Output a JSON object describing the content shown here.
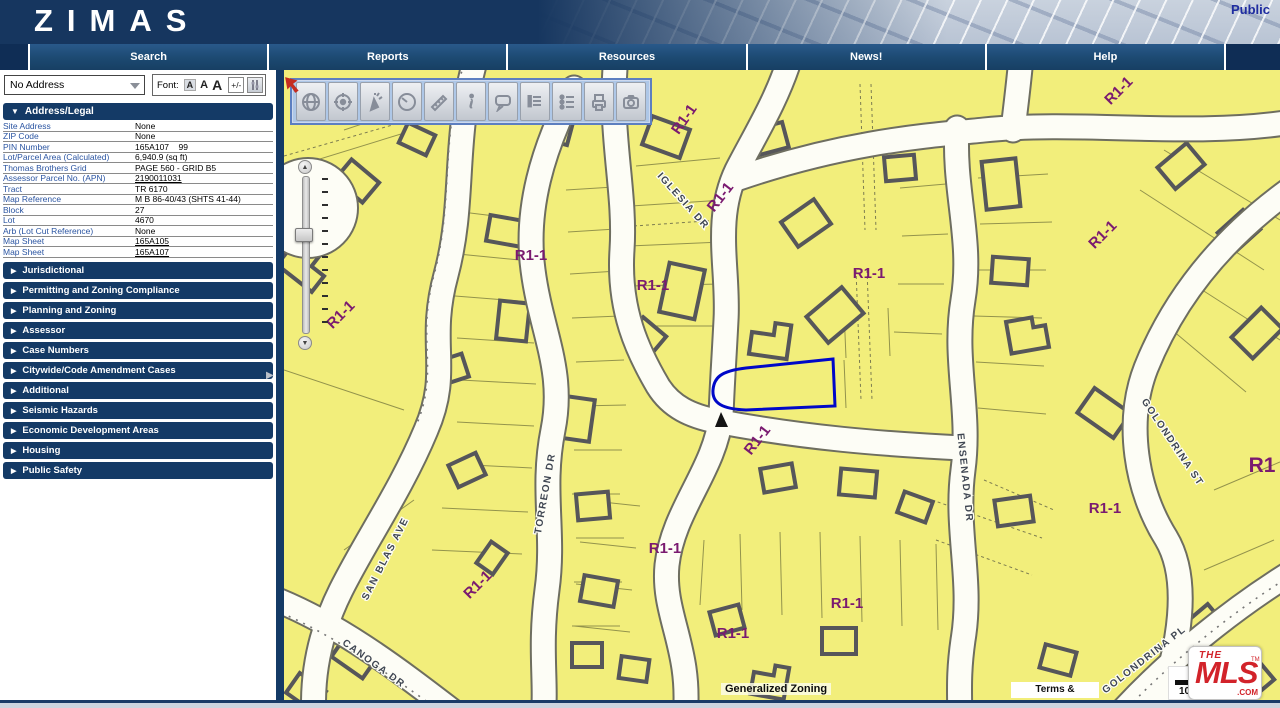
{
  "header": {
    "logo": "ZIMAS",
    "public_label": "Public"
  },
  "tabs": [
    {
      "label": "Search"
    },
    {
      "label": "Reports"
    },
    {
      "label": "Resources"
    },
    {
      "label": "News!"
    },
    {
      "label": "Help"
    }
  ],
  "sidebar": {
    "address_dropdown_value": "No Address",
    "font_label": "Font:",
    "font_sizes": [
      "A",
      "A",
      "A"
    ],
    "font_plusminus": "+/-",
    "address_legal": {
      "title": "Address/Legal",
      "rows": [
        {
          "label": "Site Address",
          "value": "None",
          "link": false
        },
        {
          "label": "ZIP Code",
          "value": "None",
          "link": false
        },
        {
          "label": "PIN Number",
          "value": "165A107    99",
          "link": false
        },
        {
          "label": "Lot/Parcel Area (Calculated)",
          "value": "6,940.9 (sq ft)",
          "link": false
        },
        {
          "label": "Thomas Brothers Grid",
          "value": "PAGE 560 - GRID B5",
          "link": false
        },
        {
          "label": "Assessor Parcel No. (APN)",
          "value": "2190011031",
          "link": true
        },
        {
          "label": "Tract",
          "value": "TR 6170",
          "link": false
        },
        {
          "label": "Map Reference",
          "value": "M B 86-40/43 (SHTS 41-44)",
          "link": false
        },
        {
          "label": "Block",
          "value": "27",
          "link": false
        },
        {
          "label": "Lot",
          "value": "4670",
          "link": false
        },
        {
          "label": "Arb (Lot Cut Reference)",
          "value": "None",
          "link": false
        },
        {
          "label": "Map Sheet",
          "value": "165A105",
          "link": true
        },
        {
          "label": "Map Sheet",
          "value": "165A107",
          "link": true
        }
      ]
    },
    "sections": [
      "Jurisdictional",
      "Permitting and Zoning Compliance",
      "Planning and Zoning",
      "Assessor",
      "Case Numbers",
      "Citywide/Code Amendment Cases",
      "Additional",
      "Seismic Hazards",
      "Economic Development Areas",
      "Housing",
      "Public Safety"
    ]
  },
  "map": {
    "toolbar_buttons": [
      "globe",
      "locate",
      "select-arrow",
      "clock",
      "measure",
      "info",
      "comment",
      "report",
      "legend",
      "print",
      "photo"
    ],
    "zone_labels": [
      {
        "text": "R1-1",
        "x": 404,
        "y": 52,
        "rot": -55,
        "big": false
      },
      {
        "text": "R1-1",
        "x": 440,
        "y": 130,
        "rot": -52,
        "big": false
      },
      {
        "text": "R1-1",
        "x": 247,
        "y": 190,
        "rot": 0,
        "big": false
      },
      {
        "text": "R1-1",
        "x": 369,
        "y": 220,
        "rot": 0,
        "big": false
      },
      {
        "text": "R1-1",
        "x": 60,
        "y": 248,
        "rot": -45,
        "big": false
      },
      {
        "text": "R1-1",
        "x": 585,
        "y": 208,
        "rot": 0,
        "big": false
      },
      {
        "text": "R1-1",
        "x": 822,
        "y": 168,
        "rot": -45,
        "big": false
      },
      {
        "text": "R1-1",
        "x": 838,
        "y": 24,
        "rot": -45,
        "big": false
      },
      {
        "text": "R1-1",
        "x": 477,
        "y": 373,
        "rot": -52,
        "big": false
      },
      {
        "text": "R1-1",
        "x": 381,
        "y": 483,
        "rot": 0,
        "big": false
      },
      {
        "text": "R1-1",
        "x": 197,
        "y": 518,
        "rot": -45,
        "big": false
      },
      {
        "text": "R1-1",
        "x": 449,
        "y": 568,
        "rot": 0,
        "big": false
      },
      {
        "text": "R1-1",
        "x": 563,
        "y": 538,
        "rot": 0,
        "big": false
      },
      {
        "text": "R1-1",
        "x": 821,
        "y": 443,
        "rot": 0,
        "big": false
      },
      {
        "text": "R1",
        "x": 978,
        "y": 402,
        "rot": 0,
        "big": true
      }
    ],
    "street_labels": [
      {
        "text": "IGLESIA DR",
        "x": 397,
        "y": 133,
        "rot": 48
      },
      {
        "text": "TORREON DR",
        "x": 264,
        "y": 424,
        "rot": -80
      },
      {
        "text": "SAN BLAS AVE",
        "x": 104,
        "y": 490,
        "rot": -63
      },
      {
        "text": "CANOGA DR",
        "x": 88,
        "y": 596,
        "rot": 36
      },
      {
        "text": "ENSENADA DR",
        "x": 678,
        "y": 408,
        "rot": 84
      },
      {
        "text": "GOLONDRINA ST",
        "x": 886,
        "y": 374,
        "rot": 56
      },
      {
        "text": "GOLONDRINA PL",
        "x": 862,
        "y": 592,
        "rot": -38
      }
    ],
    "footer": {
      "generalized_zoning": "Generalized Zoning",
      "terms": "Terms & Conditions",
      "scale_text": "100 F.",
      "mls_the": "THE",
      "mls_word": "MLS",
      "mls_tm": "TM",
      "mls_com": ".COM"
    }
  },
  "colors": {
    "header_navy": "#16365F",
    "section_navy": "#143a66",
    "tab_blue": "#1d4e7c",
    "parcel_yellow": "#f2ee7b",
    "street_white": "#fdfdf6",
    "zone_label_purple": "#7a1a70",
    "selection_blue": "#0008c8",
    "building_gray": "#56565a",
    "mls_red": "#d2232a",
    "label_link_blue": "#2b55a2"
  }
}
